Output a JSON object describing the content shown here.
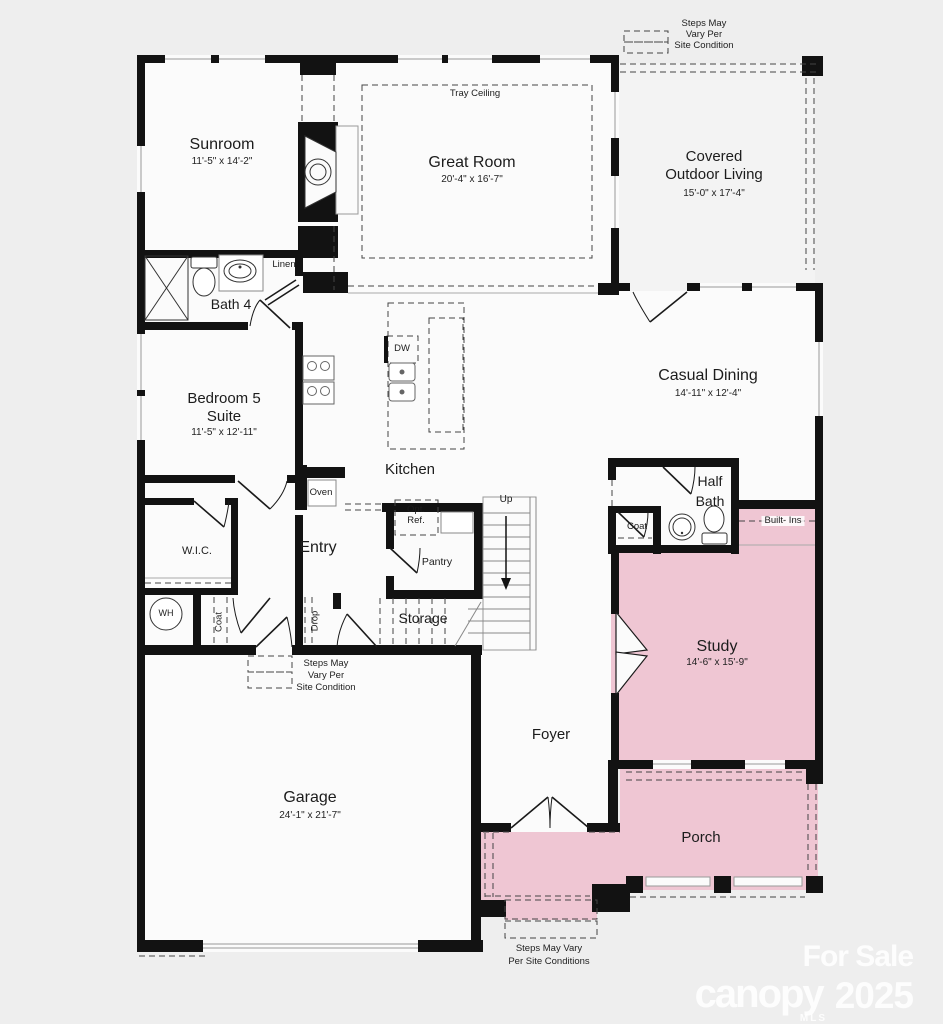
{
  "rooms": {
    "sunroom": {
      "name": "Sunroom",
      "dims": "11'-5\" x 14'-2\""
    },
    "great_room": {
      "name": "Great Room",
      "dims": "20'-4\" x 16'-7\"",
      "ceiling_note": "Tray Ceiling"
    },
    "covered_outdoor_living": {
      "name_line1": "Covered",
      "name_line2": "Outdoor Living",
      "dims": "15'-0\" x 17'-4\""
    },
    "bath_4": {
      "name": "Bath 4"
    },
    "bedroom_5": {
      "name_line1": "Bedroom 5",
      "name_line2": "Suite",
      "dims": "11'-5\" x 12'-11\""
    },
    "kitchen": {
      "name": "Kitchen"
    },
    "casual_dining": {
      "name": "Casual Dining",
      "dims": "14'-11\" x 12'-4\""
    },
    "half_bath": {
      "name_line1": "Half",
      "name_line2": "Bath"
    },
    "study": {
      "name": "Study",
      "dims": "14'-6\" x 15'-9\""
    },
    "entry": {
      "name": "Entry"
    },
    "wic": {
      "name": "W.I.C."
    },
    "storage": {
      "name": "Storage"
    },
    "garage": {
      "name": "Garage",
      "dims": "24'-1\" x 21'-7\""
    },
    "foyer": {
      "name": "Foyer"
    },
    "porch": {
      "name": "Porch"
    }
  },
  "features": {
    "linen": "Linen",
    "oven": "Oven",
    "dw": "DW",
    "opt_ref_line1": "Opt.",
    "opt_ref_line2": "Ref.",
    "pantry": "Pantry",
    "coat_entry": "Coat",
    "coat_half_bath": "Coat",
    "drop": "Drop",
    "built_ins": "Built- Ins",
    "wh": "WH",
    "up": "Up"
  },
  "notes": {
    "top": [
      "Steps May",
      "Vary Per",
      "Site Condition"
    ],
    "garage_entry": [
      "Steps May",
      "Vary Per",
      "Site Condition"
    ],
    "porch": [
      "Steps May Vary",
      "Per Site Conditions"
    ]
  },
  "watermark": {
    "for_sale": "For Sale",
    "brand": "canopy",
    "brand_sub": "MLS",
    "year": "2025"
  },
  "colors": {
    "highlight_pink": "#efc6d3",
    "background": "#eeeeee",
    "wall": "#121212"
  }
}
